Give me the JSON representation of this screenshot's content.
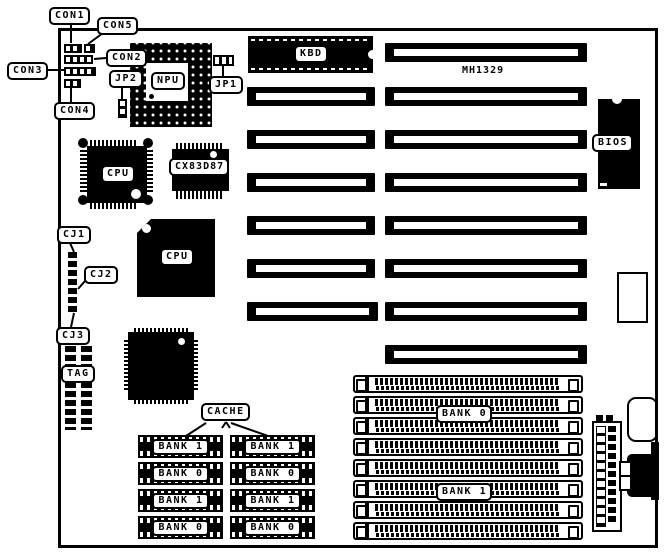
{
  "diagram": {
    "board_model": "MH1329",
    "callouts": {
      "con1": "CON1",
      "con5": "CON5",
      "con2": "CON2",
      "con3": "CON3",
      "con4": "CON4",
      "jp1": "JP1",
      "jp2": "JP2",
      "cj1": "CJ1",
      "cj2": "CJ2",
      "cj3": "CJ3",
      "tag": "TAG",
      "cache": "CACHE"
    },
    "chips": {
      "npu": "NPU",
      "kbd": "KBD",
      "bios": "BIOS",
      "cpu_qfp": "CPU",
      "cpu_plcc": "CPU",
      "coprocessor": "CX83D87"
    },
    "memory": {
      "cache_left": [
        "BANK 1",
        "BANK 0",
        "BANK 1",
        "BANK 0"
      ],
      "cache_right": [
        "BANK 1",
        "BANK 0",
        "BANK 1",
        "BANK 0"
      ],
      "simm_top_bank": "BANK 0",
      "simm_bottom_bank": "BANK 1"
    },
    "colors": {
      "ink": "#000000",
      "paper": "#ffffff"
    }
  }
}
